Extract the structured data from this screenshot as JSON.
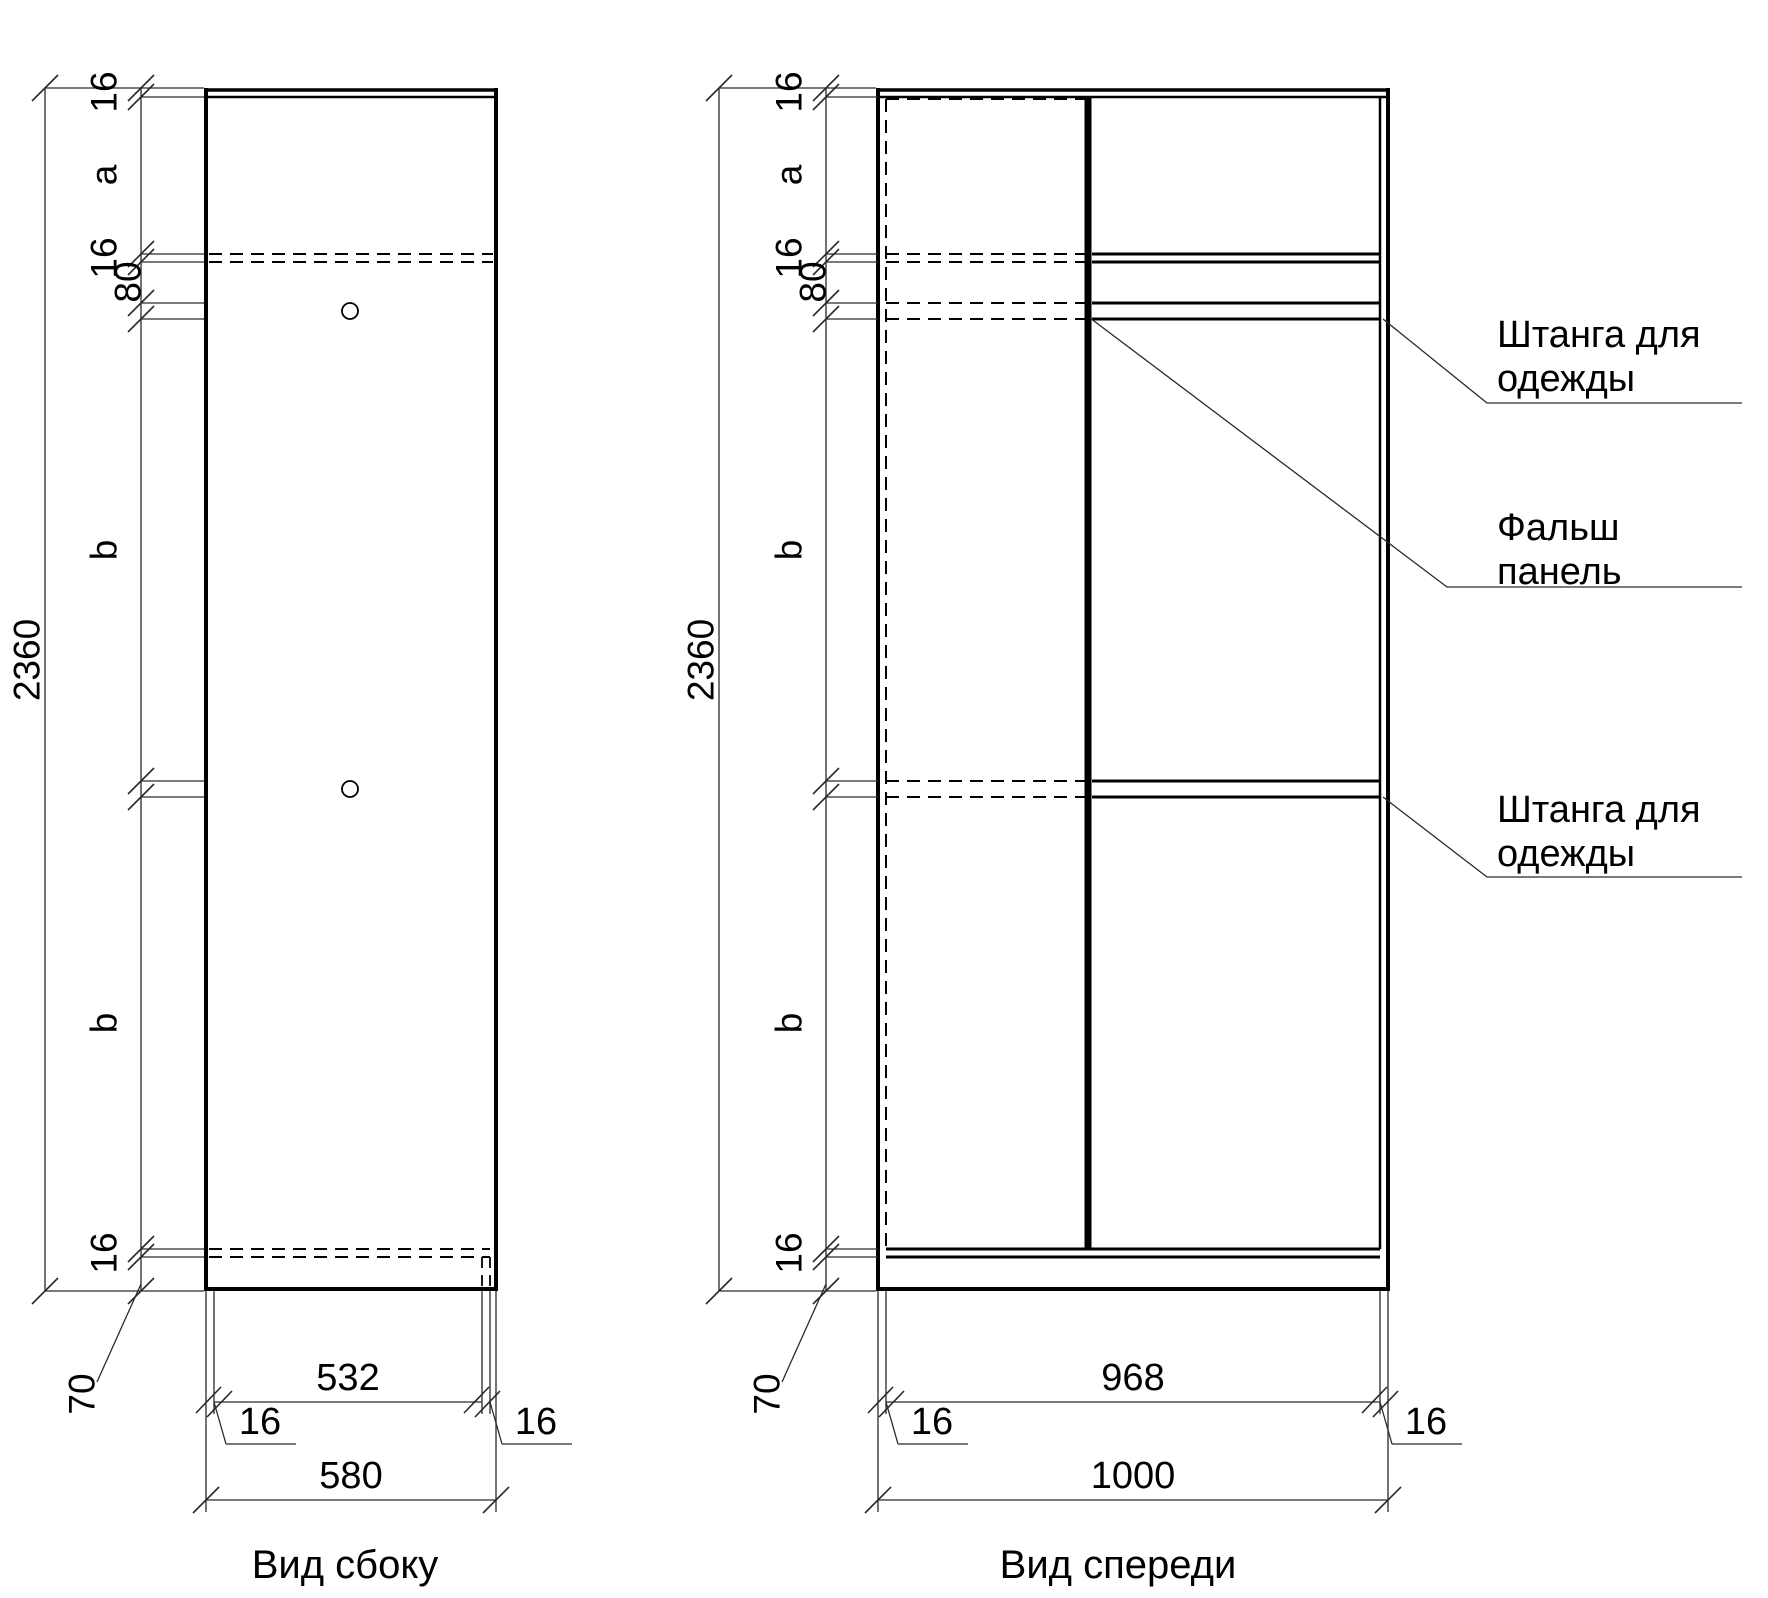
{
  "side_view": {
    "caption": "Вид сбоку",
    "height_total": "2360",
    "chain": {
      "top16": "16",
      "a": "a",
      "shelf16": "16",
      "rail80": "80",
      "b_upper": "b",
      "b_lower": "b",
      "bottom16": "16",
      "plinth70": "70"
    },
    "width": {
      "inner": "532",
      "back16": "16",
      "front16": "16",
      "total": "580"
    }
  },
  "front_view": {
    "caption": "Вид спереди",
    "height_total": "2360",
    "chain": {
      "top16": "16",
      "a": "a",
      "shelf16": "16",
      "rail80": "80",
      "b_upper": "b",
      "b_lower": "b",
      "bottom16": "16",
      "plinth70": "70"
    },
    "width": {
      "inner": "968",
      "left16": "16",
      "right16": "16",
      "total": "1000"
    },
    "annotations": {
      "rail_top": {
        "line1": "Штанга для",
        "line2": "одежды"
      },
      "false_panel": {
        "line1": "Фальш",
        "line2": "панель"
      },
      "rail_mid": {
        "line1": "Штанга для",
        "line2": "одежды"
      }
    }
  }
}
